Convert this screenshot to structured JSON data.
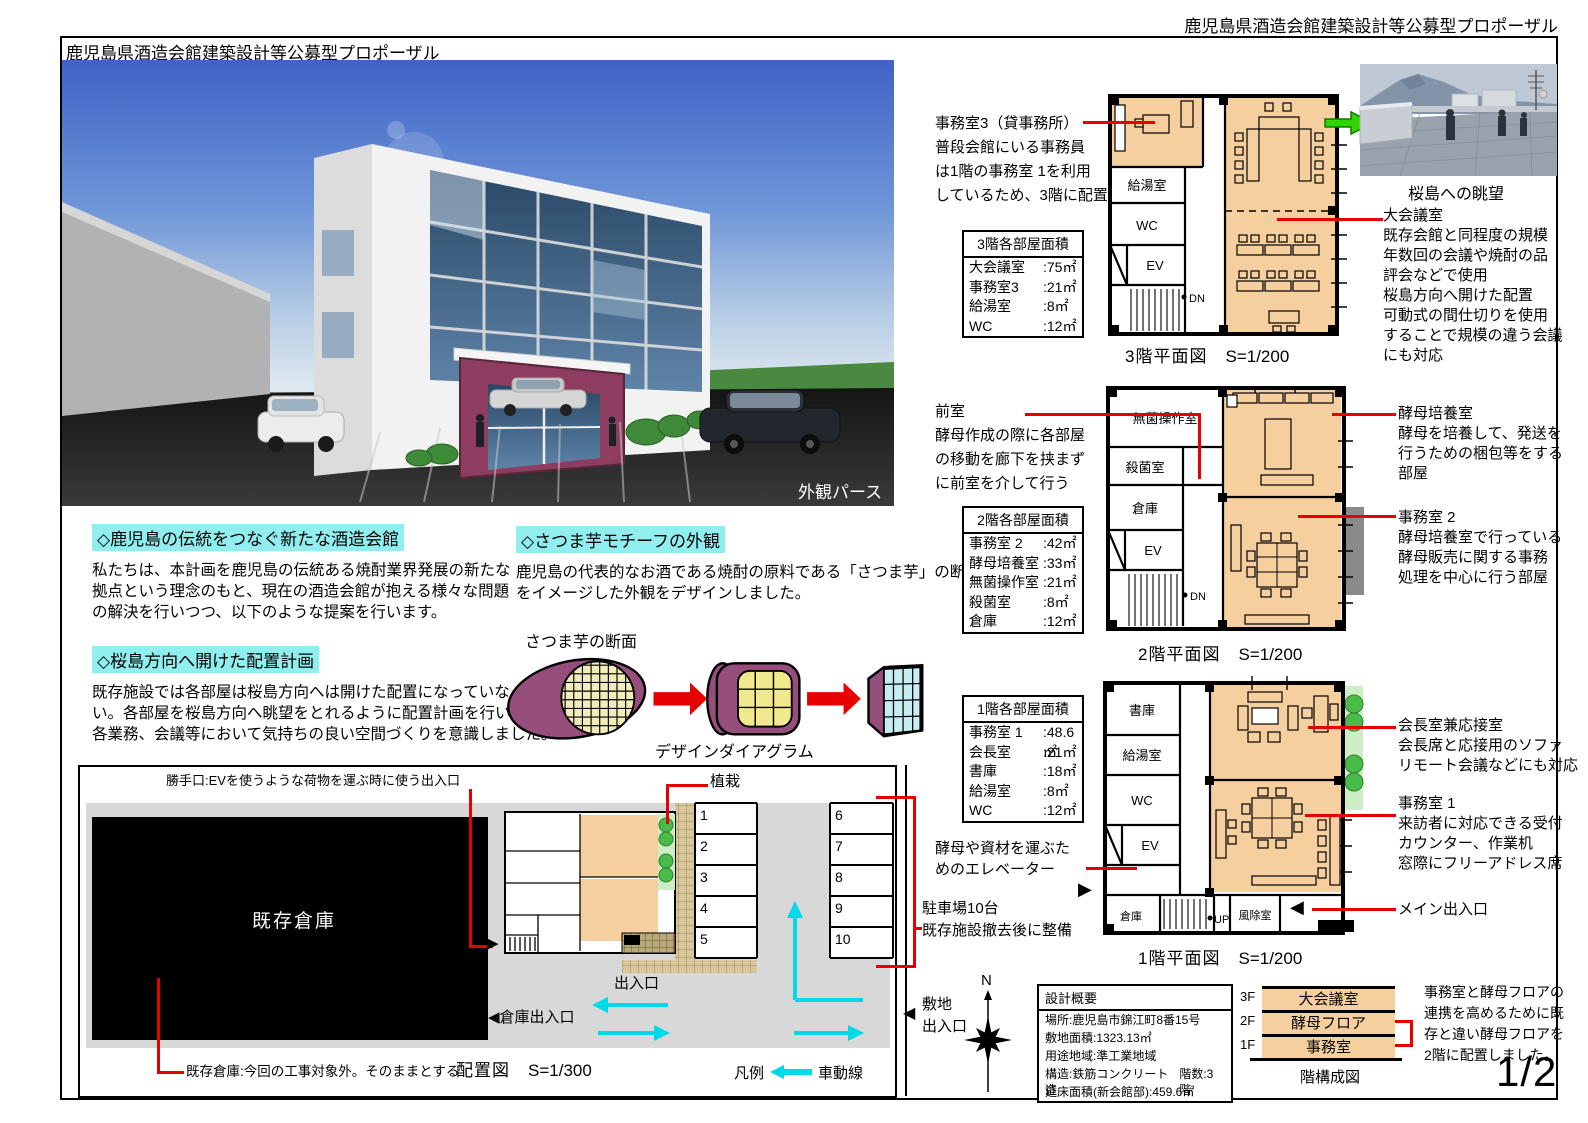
{
  "page": {
    "header_right": "鹿児島県酒造会館建築設計等公募型プロポーザル",
    "header_left": "鹿児島県酒造会館建築設計等公募型プロポーザル",
    "page_number": "1/2"
  },
  "render": {
    "caption": "外観パース"
  },
  "viewphoto": {
    "caption": "桜島への眺望"
  },
  "sections": {
    "s1": {
      "heading": "◇鹿児島の伝統をつなぐ新たな酒造会館",
      "body": "私たちは、本計画を鹿児島の伝統ある焼酎業界発展の新たな\n拠点という理念のもと、現在の酒造会館が抱える様々な問題\nの解決を行いつつ、以下のような提案を行います。"
    },
    "s2": {
      "heading": "◇桜島方向へ開けた配置計画",
      "body": "既存施設では各部屋は桜島方向へは開けた配置になっていな\nい。各部屋を桜島方向へ眺望をとれるように配置計画を行い、\n各業務、会議等において気持ちの良い空間づくりを意識しました。"
    },
    "s3": {
      "heading": "◇さつま芋モチーフの外観",
      "body": "鹿児島の代表的なお酒である焼酎の原料である「さつま芋」の断面の\nをイメージした外観をデザインしました。",
      "diagram_label": "さつま芋の断面",
      "diagram_caption": "デザインダイアグラム"
    }
  },
  "floor3": {
    "title": "3階平面図",
    "scale": "S=1/200",
    "office_note": "事務室3（貸事務所）\n普段会館にいる事務員\nは1階の事務室 1を利用\nしているため、3階に配置",
    "meeting_note": "大会議室\n既存会館と同程度の規模\n年数回の会議や焼酎の品\n評会などで使用\n桜島方向へ開けた配置\n可動式の間仕切りを使用\nすることで規模の違う会議\nにも対応",
    "table": {
      "header": "3階各部屋面積",
      "rows": [
        [
          "大会議室",
          ":75㎡"
        ],
        [
          "事務室3",
          ":21㎡"
        ],
        [
          "給湯室",
          ":8㎡"
        ],
        [
          "WC",
          ":12㎡"
        ]
      ]
    },
    "rooms": {
      "kyuto": "給湯室",
      "wc": "WC",
      "ev": "EV",
      "dn": "DN"
    }
  },
  "floor2": {
    "title": "2階平面図",
    "scale": "S=1/200",
    "anteroom_note": "前室\n酵母作成の際に各部屋\nの移動を廊下を挟まず\nに前室を介して行う",
    "culture_note": "酵母培養室\n酵母を培養して、発送を\n行うための梱包等をする\n部屋",
    "office_note": "事務室 2\n酵母培養室で行っている\n酵母販売に関する事務\n処理を中心に行う部屋",
    "table": {
      "header": "2階各部屋面積",
      "rows": [
        [
          "事務室 2",
          ":42㎡"
        ],
        [
          "酵母培養室",
          ":33㎡"
        ],
        [
          "無菌操作室",
          ":21㎡"
        ],
        [
          "殺菌室",
          ":8㎡"
        ],
        [
          "倉庫",
          ":12㎡"
        ]
      ]
    },
    "rooms": {
      "clean": "無菌操作室",
      "sterilize": "殺菌室",
      "storage": "倉庫",
      "ev": "EV",
      "dn": "DN"
    }
  },
  "floor1": {
    "title": "1階平面図",
    "scale": "S=1/200",
    "ev_note": "酵母や資材を運ぶた\nめのエレベーター",
    "parking_note": "駐車場10台\n既存施設撤去後に整備",
    "president_note": "会長室兼応接室\n会長席と応接用のソファ\nリモート会議などにも対応",
    "office_note": "事務室 1\n来訪者に対応できる受付\nカウンター、作業机\n窓際にフリーアドレス席",
    "entrance_note": "メイン出入口",
    "table": {
      "header": "1階各部屋面積",
      "rows": [
        [
          "事務室 1",
          ":48.6㎡"
        ],
        [
          "会長室",
          ":21㎡"
        ],
        [
          "書庫",
          ":18㎡"
        ],
        [
          "給湯室",
          ":8㎡"
        ],
        [
          "WC",
          ":12㎡"
        ]
      ]
    },
    "rooms": {
      "shoko": "書庫",
      "kyuto": "給湯室",
      "wc": "WC",
      "ev": "EV",
      "soko": "倉庫",
      "up": "UP",
      "fujo": "風除室"
    }
  },
  "site": {
    "caption": "配置図",
    "scale": "S=1/300",
    "kitchen_door_note": "勝手口:EVを使うような荷物を運ぶ時に使う出入口",
    "planting_label": "植栽",
    "warehouse_label": "既存倉庫",
    "warehouse_note": "既存倉庫:今回の工事対象外。そのままとする",
    "entrance_label": "出入口",
    "warehouse_entrance_label": "◀倉庫出入口",
    "site_entrance_arrow": "◀",
    "site_entrance_label": "敷地\n出入口",
    "legend_label": "凡例",
    "legend_item": "車動線",
    "north_label": "N",
    "stalls": [
      "1",
      "2",
      "3",
      "4",
      "5",
      "6",
      "7",
      "8",
      "9",
      "10"
    ]
  },
  "summary": {
    "title": "設計概要",
    "rows": [
      "場所:鹿児島市錦江町8番15号",
      "敷地面積:1323.13㎡",
      "用途地域:準工業地域",
      "構造:鉄筋コンクリート造",
      "延床面積(新会館部):459.6㎡"
    ],
    "floors_value": "階数:3階"
  },
  "stack": {
    "caption": "階構成図",
    "levels": [
      {
        "label": "3F",
        "room": "大会議室"
      },
      {
        "label": "2F",
        "room": "酵母フロア"
      },
      {
        "label": "1F",
        "room": "事務室"
      }
    ],
    "note": "事務室と酵母フロアの\n連携を高めるために既\n存と違い酵母フロアを\n2階に配置しました。"
  },
  "colors": {
    "accent_red": "#e60000",
    "highlight_cyan": "#90eeee",
    "room_orange": "#f6cf9e",
    "arrow_cyan": "#00d9e6",
    "arrow_green": "#2fd500",
    "potato_purple": "#964f7d"
  }
}
